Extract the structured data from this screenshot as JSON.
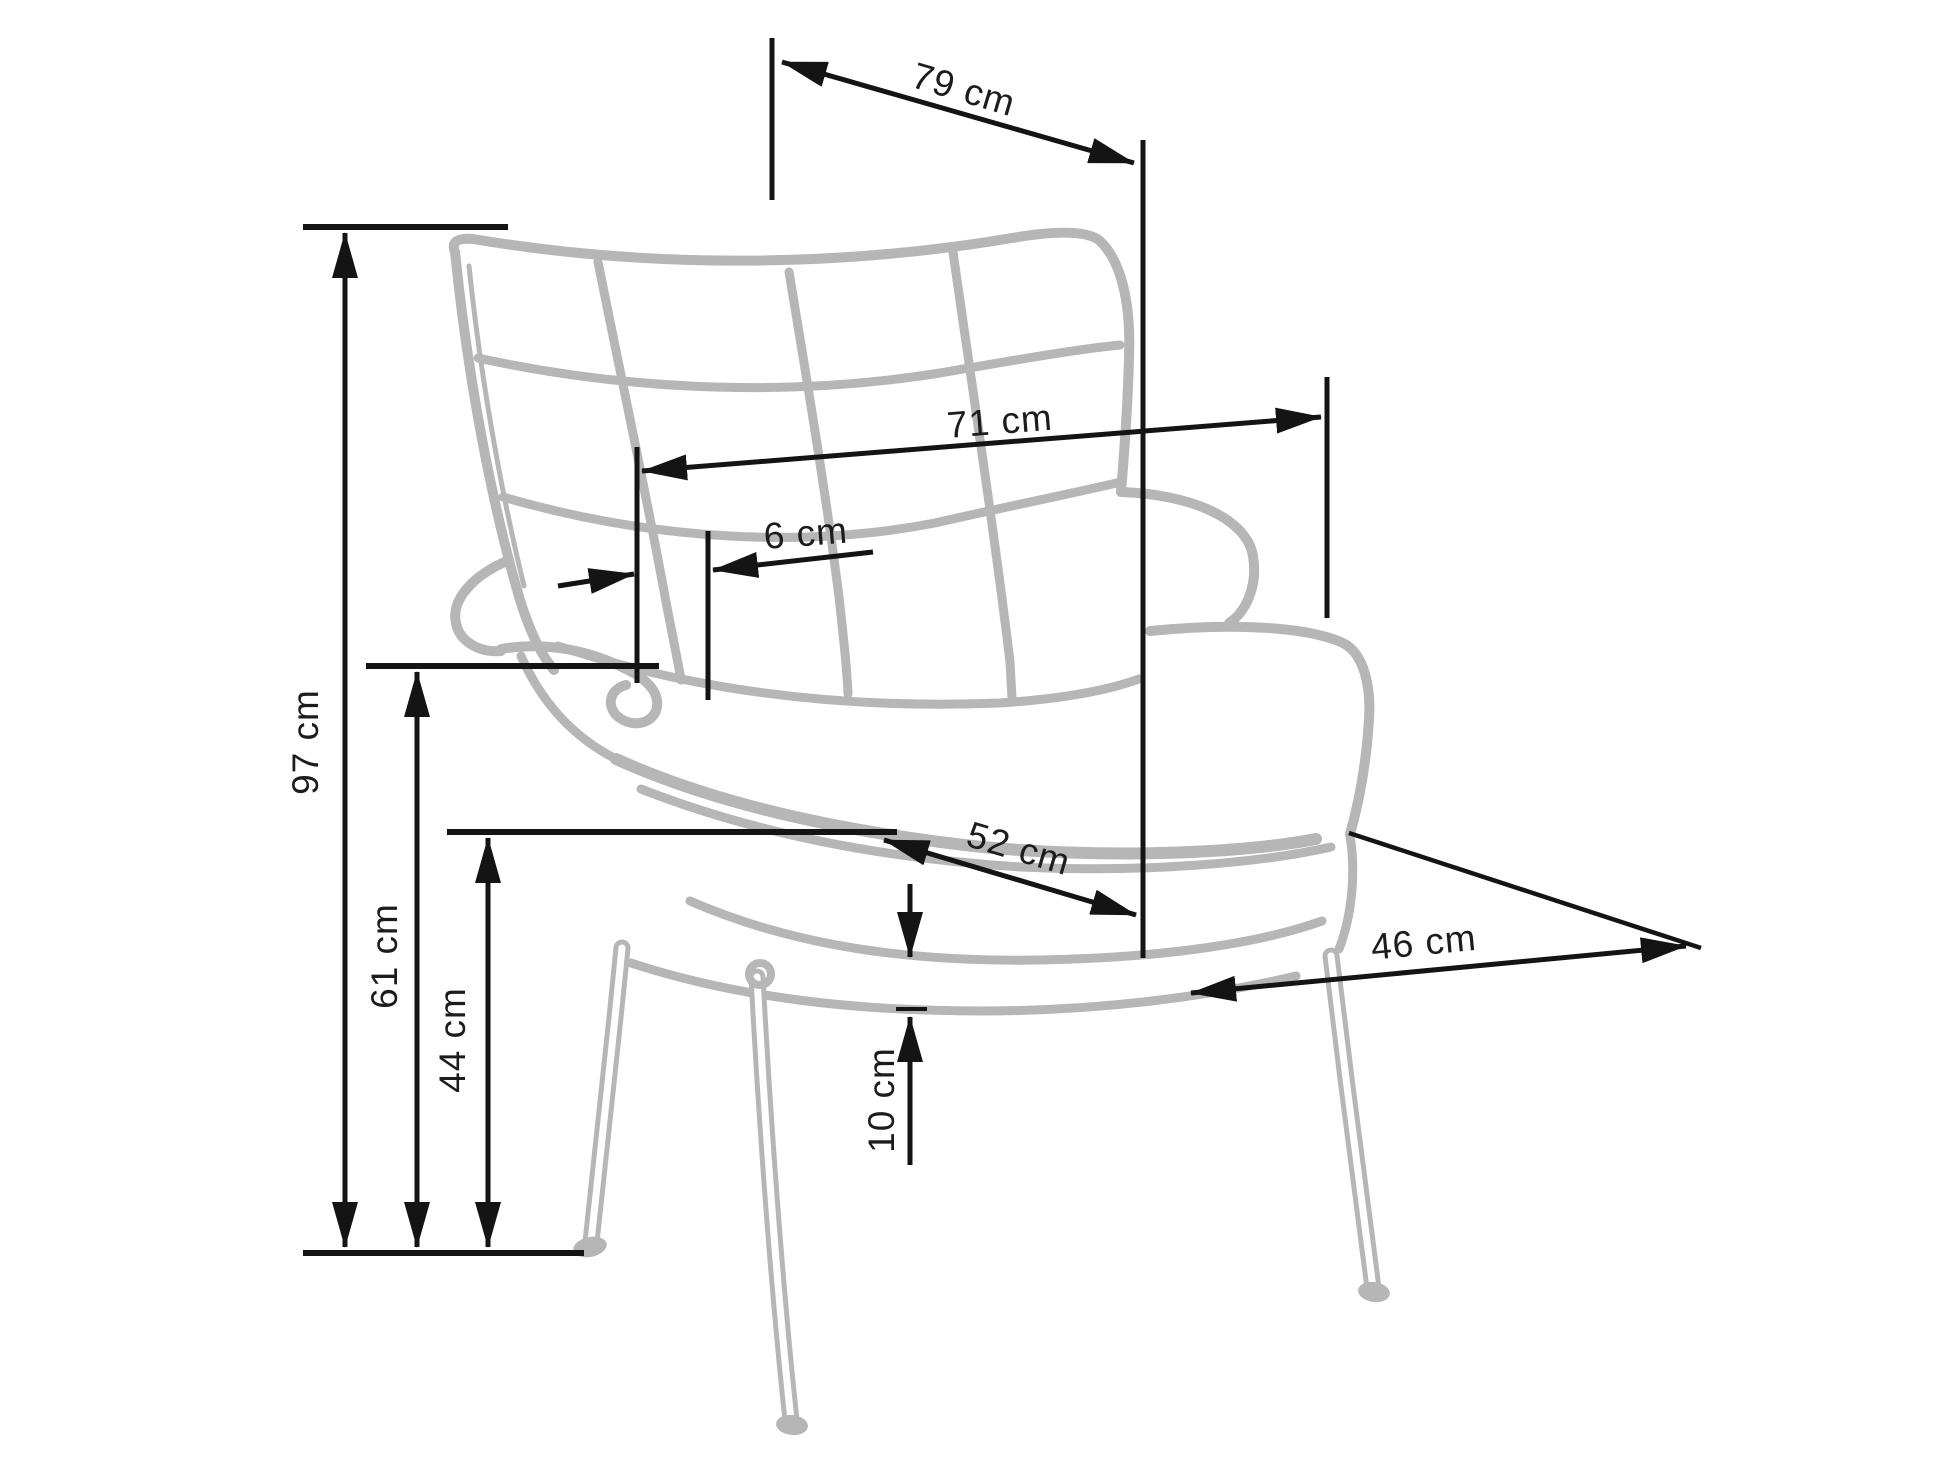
{
  "page": {
    "title": "Wingback armchair dimension diagram",
    "unit": "cm",
    "background": "#ffffff"
  },
  "colors": {
    "chair_outline": "#b6b6b6",
    "dimension_lines": "#141414",
    "label_text": "#1c1c1c"
  },
  "dims": [
    {
      "id": "total-height",
      "value": "97 cm"
    },
    {
      "id": "armrest-height",
      "value": "61 cm"
    },
    {
      "id": "seat-height",
      "value": "44 cm"
    },
    {
      "id": "overall-depth",
      "value": "79 cm"
    },
    {
      "id": "back-width",
      "value": "71 cm"
    },
    {
      "id": "headrest-offset",
      "value": "6 cm"
    },
    {
      "id": "seat-width",
      "value": "52 cm"
    },
    {
      "id": "seat-depth",
      "value": "46 cm"
    },
    {
      "id": "cushion-thickness",
      "value": "10 cm"
    }
  ]
}
